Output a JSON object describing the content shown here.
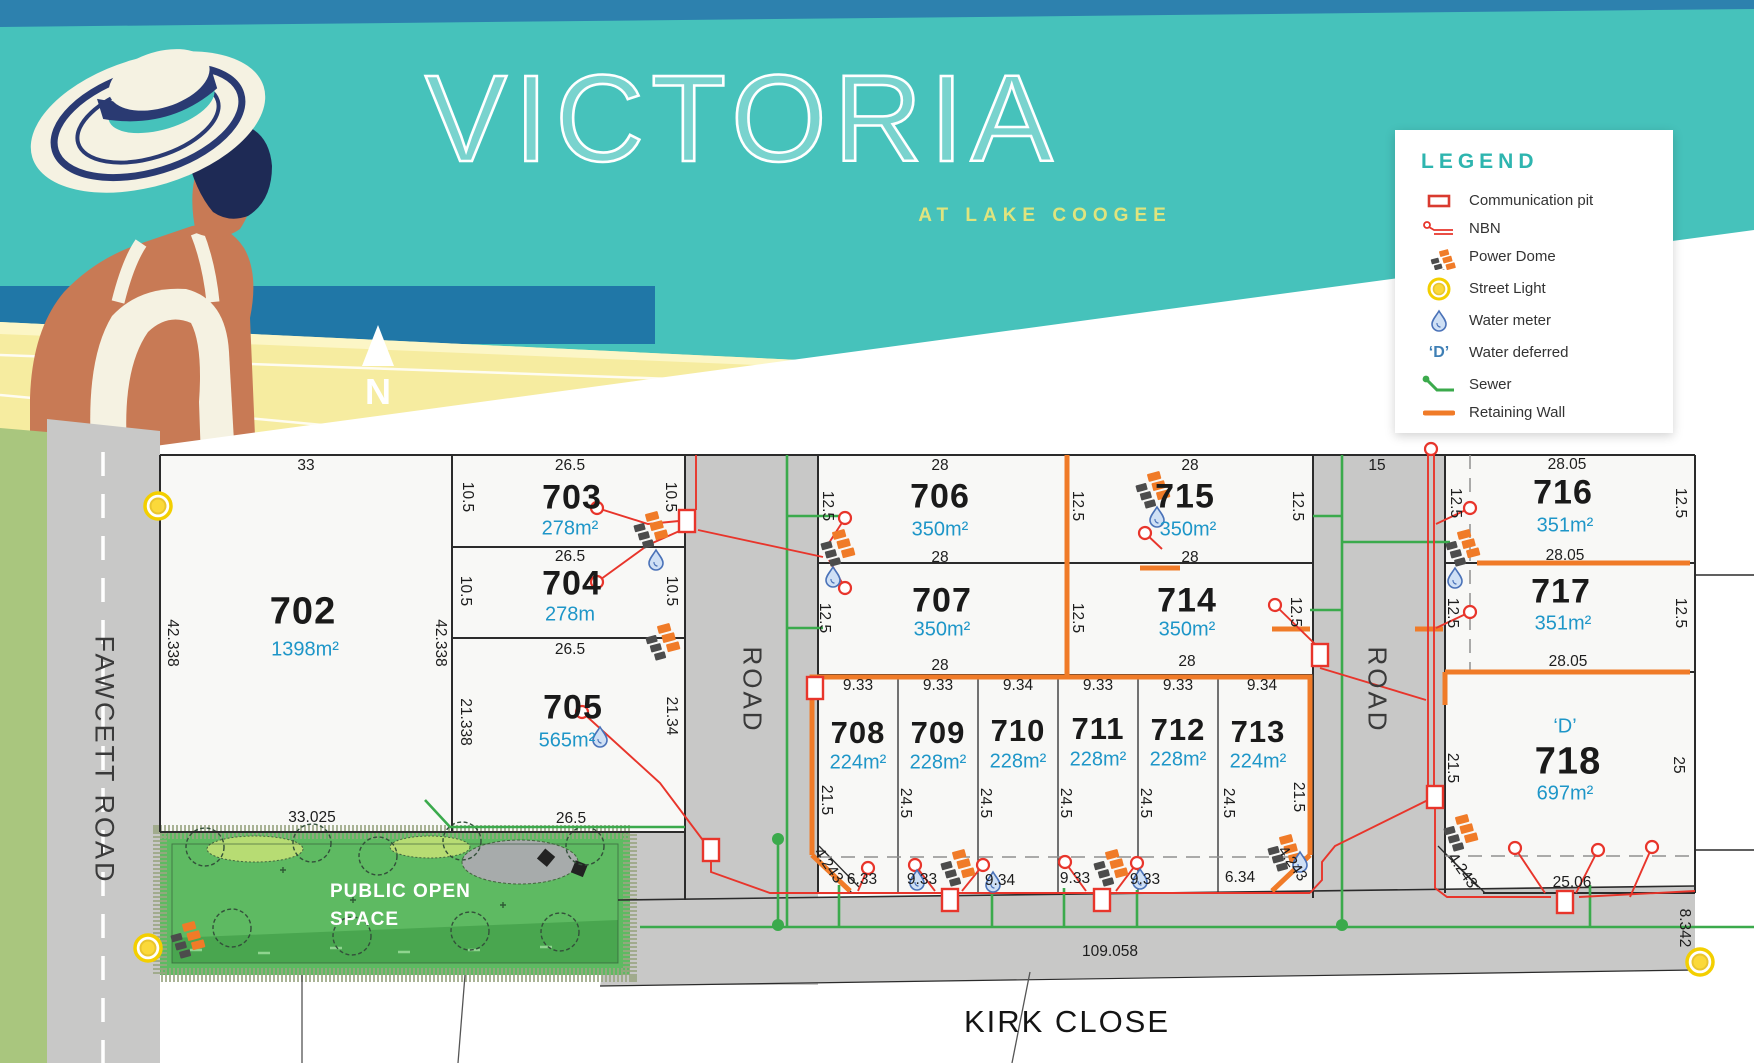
{
  "header": {
    "title": "VICTORIA",
    "subtitle": "AT LAKE COOGEE",
    "north_label": "N"
  },
  "legend": {
    "title": "LEGEND",
    "items": [
      {
        "id": "communication-pit",
        "label": "Communication pit"
      },
      {
        "id": "nbn",
        "label": "NBN"
      },
      {
        "id": "power-dome",
        "label": "Power Dome"
      },
      {
        "id": "street-light",
        "label": "Street Light"
      },
      {
        "id": "water-meter",
        "label": "Water meter"
      },
      {
        "id": "water-deferred",
        "label": "Water deferred",
        "glyph": "‘D’"
      },
      {
        "id": "sewer",
        "label": "Sewer"
      },
      {
        "id": "retaining-wall",
        "label": "Retaining Wall"
      }
    ]
  },
  "roads": {
    "fawcett": "FAWCETT ROAD",
    "kirk": "KIRK CLOSE",
    "road1": "ROAD",
    "road2": "ROAD"
  },
  "pos": {
    "line1": "PUBLIC OPEN",
    "line2": "SPACE"
  },
  "colors": {
    "teal": "#46c2bb",
    "sea_blue": "#2077a7",
    "deck_yellow": "#f6eca0",
    "accent_yellow": "#dfe47e",
    "legend_teal": "#2eb5af",
    "area_blue": "#1e96c8",
    "nbn_red": "#e8352b",
    "retaining_orange": "#f07b28",
    "sewer_green": "#3baa4c",
    "road_gray": "#c8c8c7",
    "pos_green": "#5eba62"
  },
  "lots": [
    {
      "number": "702",
      "area": "1398m²",
      "nx": 303,
      "ny": 612,
      "ax": 305,
      "ay": 650,
      "fs": 38
    },
    {
      "number": "703",
      "area": "278m²",
      "nx": 572,
      "ny": 498,
      "ax": 570,
      "ay": 529,
      "fs": 34
    },
    {
      "number": "704",
      "area": "278m",
      "nx": 572,
      "ny": 584,
      "ax": 570,
      "ay": 615,
      "fs": 34
    },
    {
      "number": "705",
      "area": "565m²",
      "nx": 573,
      "ny": 708,
      "ax": 567,
      "ay": 741,
      "fs": 34
    },
    {
      "number": "706",
      "area": "350m²",
      "nx": 940,
      "ny": 497,
      "ax": 940,
      "ay": 530,
      "fs": 34
    },
    {
      "number": "707",
      "area": "350m²",
      "nx": 942,
      "ny": 601,
      "ax": 942,
      "ay": 630,
      "fs": 34
    },
    {
      "number": "715",
      "area": "350m²",
      "nx": 1185,
      "ny": 497,
      "ax": 1188,
      "ay": 530,
      "fs": 34
    },
    {
      "number": "714",
      "area": "350m²",
      "nx": 1187,
      "ny": 601,
      "ax": 1187,
      "ay": 630,
      "fs": 34
    },
    {
      "number": "708",
      "area": "224m²",
      "nx": 858,
      "ny": 733,
      "ax": 858,
      "ay": 763,
      "fs": 31
    },
    {
      "number": "709",
      "area": "228m²",
      "nx": 938,
      "ny": 733,
      "ax": 938,
      "ay": 763,
      "fs": 31
    },
    {
      "number": "710",
      "area": "228m²",
      "nx": 1018,
      "ny": 731,
      "ax": 1018,
      "ay": 762,
      "fs": 31
    },
    {
      "number": "711",
      "area": "228m²",
      "nx": 1098,
      "ny": 729,
      "ax": 1098,
      "ay": 760,
      "fs": 31
    },
    {
      "number": "712",
      "area": "228m²",
      "nx": 1178,
      "ny": 730,
      "ax": 1178,
      "ay": 760,
      "fs": 31
    },
    {
      "number": "713",
      "area": "224m²",
      "nx": 1258,
      "ny": 732,
      "ax": 1258,
      "ay": 762,
      "fs": 31
    },
    {
      "number": "716",
      "area": "351m²",
      "nx": 1563,
      "ny": 493,
      "ax": 1565,
      "ay": 526,
      "fs": 34
    },
    {
      "number": "717",
      "area": "351m²",
      "nx": 1561,
      "ny": 592,
      "ax": 1563,
      "ay": 624,
      "fs": 34
    },
    {
      "number": "718",
      "area": "697m²",
      "nx": 1568,
      "ny": 762,
      "ax": 1565,
      "ay": 794,
      "fs": 38,
      "mark": "‘D’",
      "mx": 1565,
      "my": 727
    }
  ],
  "dims": [
    [
      "33",
      306,
      466,
      0
    ],
    [
      "26.5",
      570,
      466,
      0
    ],
    [
      "28",
      940,
      466,
      0
    ],
    [
      "28",
      1190,
      466,
      0
    ],
    [
      "15",
      1377,
      466,
      0
    ],
    [
      "28.05",
      1567,
      465,
      0
    ],
    [
      "26.5",
      570,
      557,
      0
    ],
    [
      "26.5",
      570,
      650,
      0
    ],
    [
      "26.5",
      571,
      819,
      0
    ],
    [
      "33.025",
      312,
      818,
      0
    ],
    [
      "10.5",
      467,
      497,
      90
    ],
    [
      "10.5",
      465,
      591,
      90
    ],
    [
      "21.338",
      465,
      722,
      90
    ],
    [
      "10.5",
      670,
      497,
      90
    ],
    [
      "10.5",
      671,
      591,
      90
    ],
    [
      "21.34",
      671,
      716,
      90
    ],
    [
      "42.338",
      172,
      643,
      90
    ],
    [
      "42.338",
      440,
      643,
      90
    ],
    [
      "28",
      940,
      558,
      0
    ],
    [
      "28",
      940,
      666,
      0
    ],
    [
      "12.5",
      827,
      506,
      90
    ],
    [
      "12.5",
      824,
      618,
      90
    ],
    [
      "28",
      1190,
      558,
      0
    ],
    [
      "28",
      1187,
      662,
      0
    ],
    [
      "12.5",
      1077,
      506,
      90
    ],
    [
      "12.5",
      1077,
      618,
      90
    ],
    [
      "12.5",
      1297,
      506,
      90
    ],
    [
      "12.5",
      1295,
      612,
      90
    ],
    [
      "28.05",
      1565,
      556,
      0
    ],
    [
      "28.05",
      1568,
      662,
      0
    ],
    [
      "12.5",
      1455,
      503,
      90
    ],
    [
      "12.5",
      1452,
      613,
      90
    ],
    [
      "12.5",
      1680,
      503,
      90
    ],
    [
      "12.5",
      1680,
      613,
      90
    ],
    [
      "21.5",
      1452,
      768,
      90
    ],
    [
      "25",
      1678,
      765,
      90
    ],
    [
      "25.06",
      1572,
      883,
      0
    ],
    [
      "4.243",
      1462,
      871,
      55
    ],
    [
      "8.342",
      1684,
      928,
      90
    ],
    [
      "9.33",
      858,
      686,
      0
    ],
    [
      "9.33",
      938,
      686,
      0
    ],
    [
      "9.34",
      1018,
      686,
      0
    ],
    [
      "9.33",
      1098,
      686,
      0
    ],
    [
      "9.33",
      1178,
      686,
      0
    ],
    [
      "9.34",
      1262,
      686,
      0
    ],
    [
      "21.5",
      826,
      800,
      90
    ],
    [
      "24.5",
      905,
      803,
      90
    ],
    [
      "24.5",
      985,
      803,
      90
    ],
    [
      "24.5",
      1065,
      803,
      90
    ],
    [
      "24.5",
      1145,
      803,
      90
    ],
    [
      "24.5",
      1228,
      803,
      90
    ],
    [
      "21.5",
      1298,
      797,
      90
    ],
    [
      "4.243",
      828,
      866,
      55
    ],
    [
      "6.33",
      862,
      880,
      0
    ],
    [
      "9.33",
      922,
      880,
      0
    ],
    [
      "9.34",
      1000,
      881,
      0
    ],
    [
      "9.33",
      1075,
      879,
      0
    ],
    [
      "9.33",
      1145,
      880,
      0
    ],
    [
      "6.34",
      1240,
      878,
      0
    ],
    [
      "4.243",
      1292,
      864,
      55
    ],
    [
      "109.058",
      1110,
      952,
      0
    ]
  ]
}
